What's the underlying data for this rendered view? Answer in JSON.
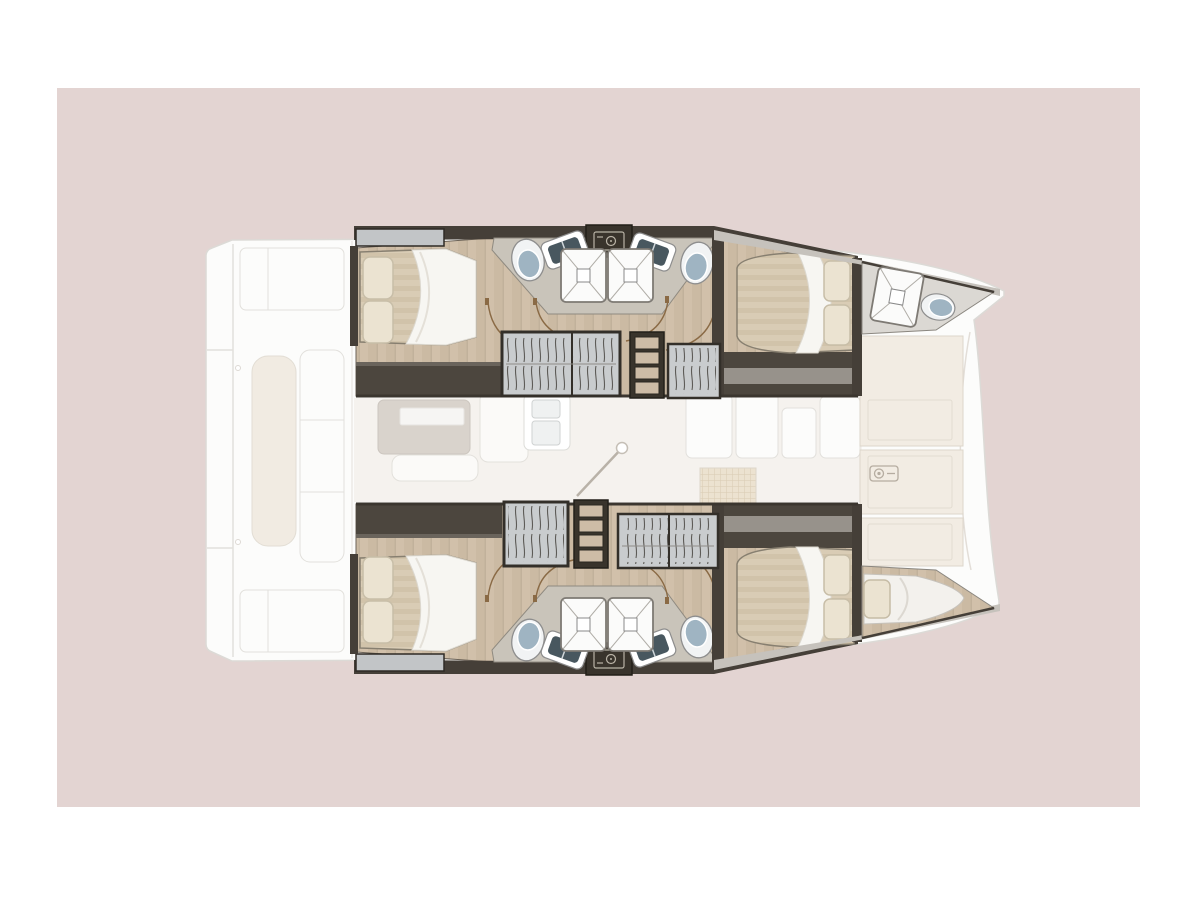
{
  "page": {
    "background": "#ffffff",
    "canvas": {
      "x": 57,
      "y": 88,
      "width": 1083,
      "height": 719,
      "color": "#e3d4d2"
    }
  },
  "figure": {
    "type": "boat-floorplan",
    "subject": "catamaran interior layout plan, top view, bow pointing right",
    "palette": {
      "pink_bg": "#e3d4d2",
      "ghost_fill": "#fcfcfb",
      "ghost_stroke": "#e2e0dc",
      "ghost_cream": "#f1ebe2",
      "ghost_sofa": "#d9d3cc",
      "salon_floor": "#f5f2ee",
      "wood": "#cbbaa3",
      "wood_stripe": "#d5c5af",
      "wall_dark": "#453f38",
      "wall_band": "#4c463e",
      "wall_grey": "#97928b",
      "bath_floor": "#c9c4ba",
      "deck_edge": "#c6c2bc",
      "mattress": "#d9ccb5",
      "mattress_stripe": "#cfc1a8",
      "duvet": "#f7f6f2",
      "pillow": "#ebe3d1",
      "pillow_stroke": "#c8beа8",
      "wardrobe_fill": "#c9ccce",
      "hanger_stroke": "#5d5b57",
      "frame_dark": "#332f29",
      "shower_fill": "#fbfbfa",
      "shower_stroke": "#7e7a74",
      "shower_x": "#b0ada7",
      "toilet_bowl": "#f1f3f4",
      "toilet_lid": "#9fb4c2",
      "sink_basin": "#48575f",
      "vanity_dark": "#39342c",
      "vanity_icon": "#b9b3a6",
      "door_arc": "#8a6a45",
      "step_wood": "#cdbca6",
      "foredeck_panel": "#f2ece3",
      "foredeck_stroke": "#ddd6cb",
      "mast_line": "#b9b2a8",
      "locker_grey": "#c2c5c7"
    },
    "inventory": {
      "double_beds": 4,
      "bow_single_berths": 1,
      "showers": 5,
      "toilets": 5,
      "bathroom_sinks": 4,
      "wardrobes": 4,
      "hull_staircases": 2,
      "cockpit_benches": 3,
      "foredeck_lockers": 3,
      "galley_sink": 1,
      "mast": 1
    },
    "regions": {
      "left": "aft cockpit and swim platforms (ghosted)",
      "center": "salon with sofa, table, galley sink, cabinets (ghosted)",
      "top": "port hull: aft cabin, twin bathrooms, forward cabin, bow shower room",
      "bottom": "starboard hull: aft cabin, twin bathrooms, forward cabin, bow berth",
      "right": "foredeck lockers with windlass between bows"
    }
  }
}
